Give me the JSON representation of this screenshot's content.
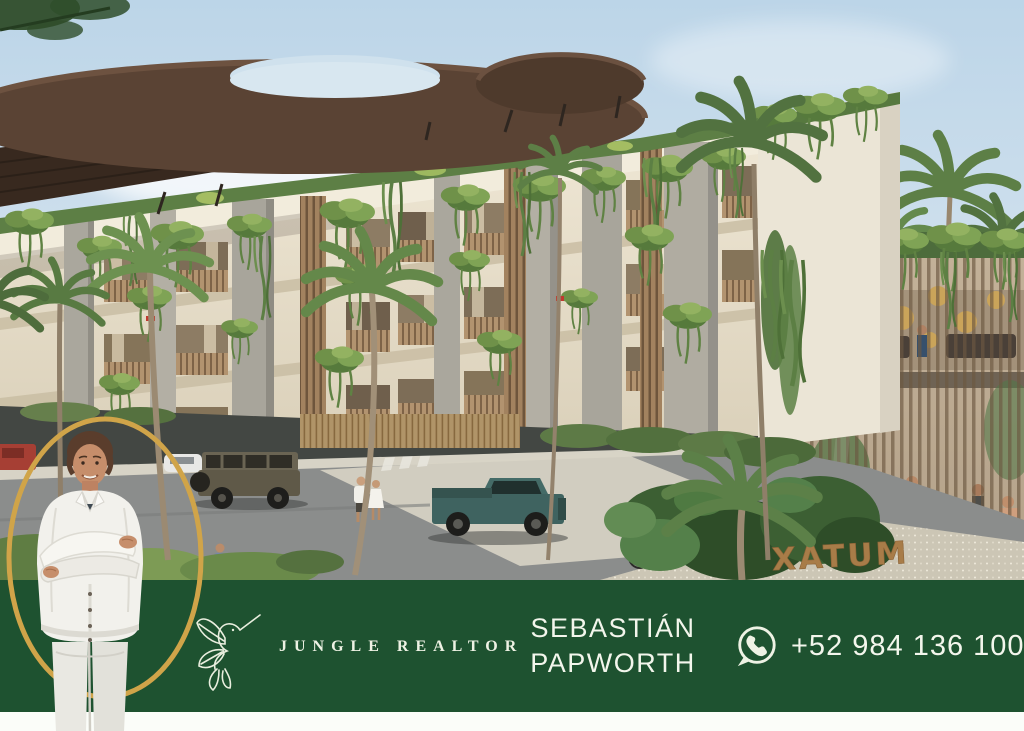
{
  "banner": {
    "brand": "JUNGLE REALTOR",
    "agent_first_name": "SEBASTIÁN",
    "agent_last_name": "PAPWORTH",
    "phone": "+52 984 136 1005",
    "logo_icon": "hummingbird-logo",
    "phone_icon": "whatsapp-icon",
    "colors": {
      "banner_green": "#1e5230",
      "gold": "#d0a449",
      "text_cream": "#eef2e4"
    }
  },
  "render": {
    "description": "Architectural rendering of tropical condo building with curved wood canopy roof, hanging gardens, palm trees, street with parked SUV and pickup truck, pedestrians, cyclist and glass amenity lobby",
    "sign_text": "XATUM"
  },
  "photo": {
    "subject": "realtor standing with crossed arms in white linen shirt"
  }
}
